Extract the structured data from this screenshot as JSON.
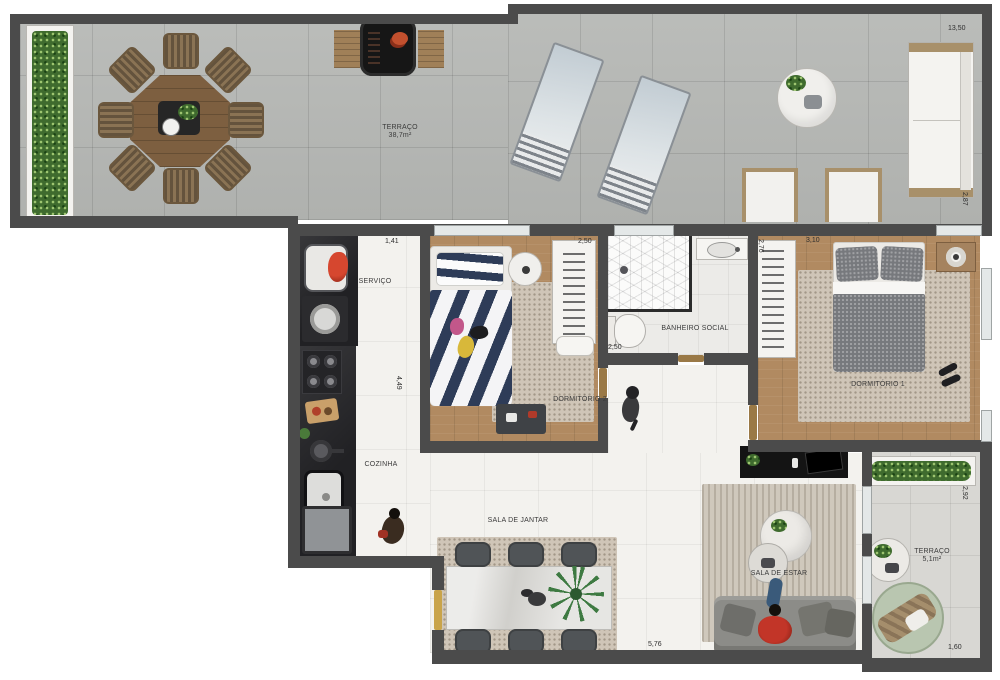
{
  "rooms": {
    "terraco": {
      "name": "TERRAÇO",
      "area": "38,7m²"
    },
    "servico": {
      "name": "SERVIÇO"
    },
    "cozinha": {
      "name": "COZINHA"
    },
    "dormitorio2": {
      "name": "DORMITÓRIO 2"
    },
    "banheiro": {
      "name": "BANHEIRO SOCIAL"
    },
    "dormitorio1": {
      "name": "DORMITÓRIO 1"
    },
    "jantar": {
      "name": "SALA DE JANTAR"
    },
    "estar": {
      "name": "SALA DE ESTAR"
    },
    "terraco2": {
      "name": "TERRAÇO",
      "area": "5,1m²"
    }
  },
  "dimensions": {
    "terraco_largura": "13,50",
    "terraco_profundidade": "2,87",
    "servico_largura": "1,41",
    "dormitorio2_largura": "2,50",
    "cozinha_altura": "4,49",
    "banheiro_largura": "2,50",
    "banheiro_altura": "2,76",
    "dormitorio1_largura": "3,10",
    "sala_largura": "5,76",
    "terraco2_altura": "2,92",
    "terraco2_largura": "1,60"
  },
  "colors": {
    "wall": "#4b4b4b",
    "wood_floor": "#b18a61",
    "terrace_tile": "#b6b8b5",
    "interior_tile": "#f3f2ee",
    "plant_green": "#3f6b2e",
    "bed2_stripe": "#2e3c58",
    "accent_red": "#c03a2a"
  }
}
